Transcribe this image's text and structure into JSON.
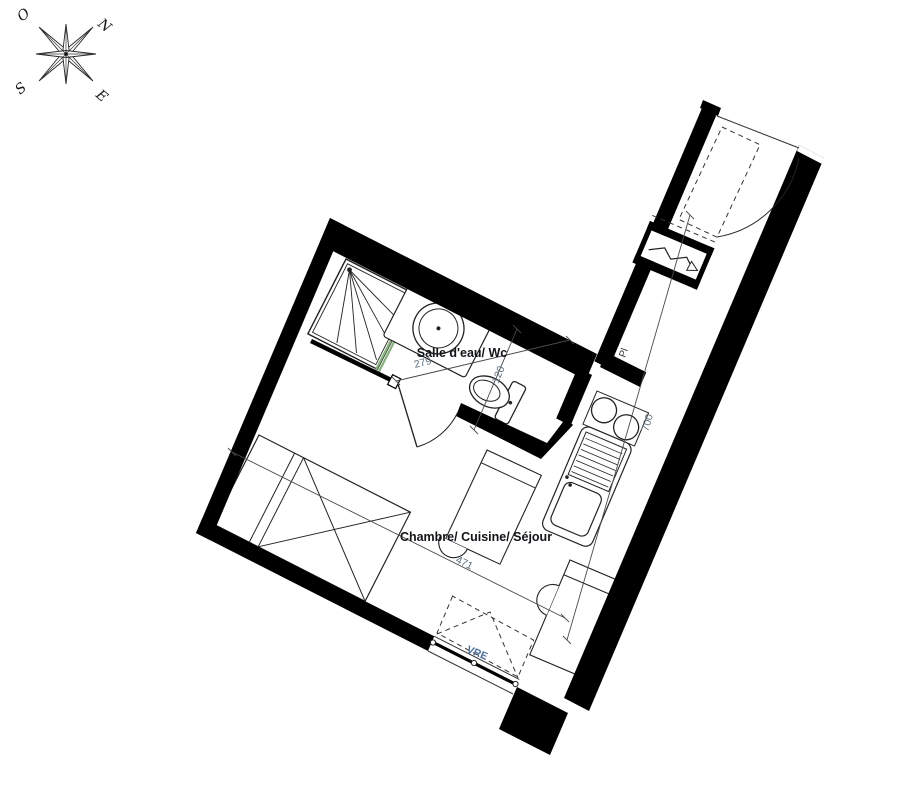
{
  "compass": {
    "n": "N",
    "o": "O",
    "s": "S",
    "e": "E"
  },
  "labels": {
    "bathroom": "Salle d'eau/ Wc",
    "main_room": "Chambre/ Cuisine/ Séjour",
    "closet": "Pl",
    "window": "VRE"
  },
  "dimensions": {
    "bathroom_width": "279",
    "wc_width": "120",
    "room_width": "471",
    "apartment_length": "700"
  },
  "colors": {
    "wall": "#000000",
    "shower_glass": "#86b07c",
    "dimension_text": "#5d6f80",
    "window_label": "#4e709b",
    "label_text": "#111418"
  }
}
